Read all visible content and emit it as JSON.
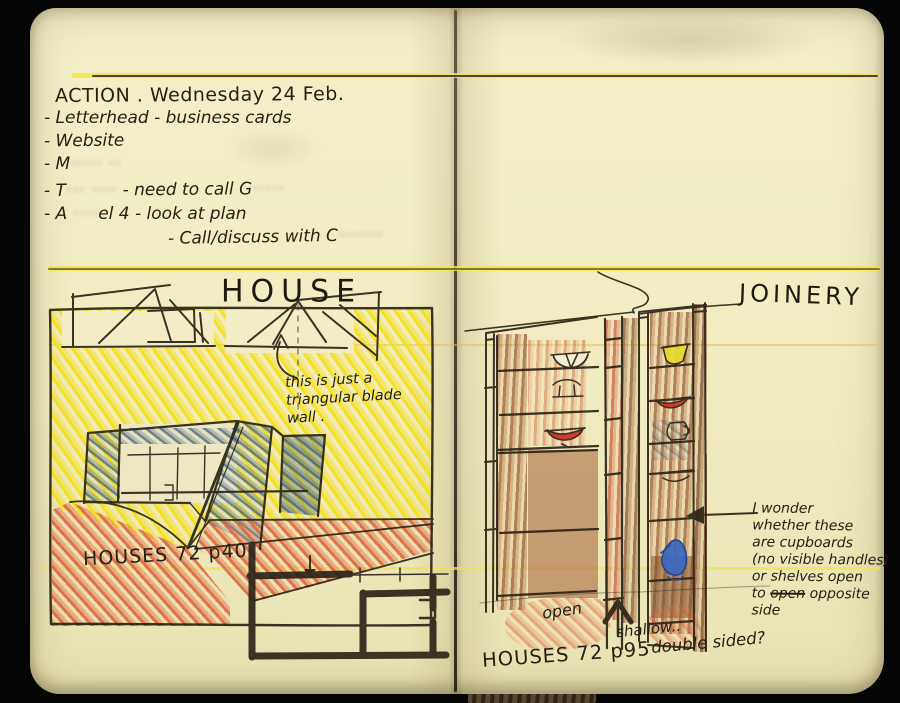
{
  "action": {
    "heading": "ACTION . Wednesday 24 Feb.",
    "item_letterhead": "- Letterhead - business cards",
    "item_website": "- Website",
    "item3_pre": "- M",
    "item3_redacted": "····· ··",
    "item4_pre": "- T",
    "item4_redacted": "··· ····",
    "item4_post": " - need to call G",
    "item4_redacted2": "·····",
    "item5_pre": "- A ",
    "item5_redacted": "····",
    "item5_post": "el 4 - look at plan",
    "item6_pre": "- Call/discuss with C",
    "item6_redacted": "·······"
  },
  "house": {
    "title": "HOUSE",
    "note_line1": "this is just a",
    "note_line2": "triangular blade",
    "note_line3": "wall .",
    "reference": "HOUSES 72 p40"
  },
  "joinery": {
    "title": "JOINERY",
    "label_open": "open",
    "label_shallow": "shallow..",
    "label_double_sided": "double sided?",
    "reference": "HOUSES 72 p95",
    "note_line1": "I wonder",
    "note_line2": "whether these",
    "note_line3": "are cupboards",
    "note_line4": "(no visible handles)",
    "note_line5": "or shelves open",
    "note_line6_pre": "to ",
    "note_line6_struck": "open",
    "note_line6_post": " opposite",
    "note_line7": "side"
  },
  "colors": {
    "background": "#050505",
    "page": "#f1ecc0",
    "pen_ink": "#2b2418",
    "highlighter": "#f3e548",
    "marker_yellow": "#f6e016",
    "wash_orange": "#db5f37",
    "wash_blue_grey": "#5c7c94",
    "wash_brown": "#b3714b",
    "bowl_red": "#cf2f27",
    "bowl_yellow": "#e7d92f",
    "jug_blue": "#3a67c0"
  }
}
